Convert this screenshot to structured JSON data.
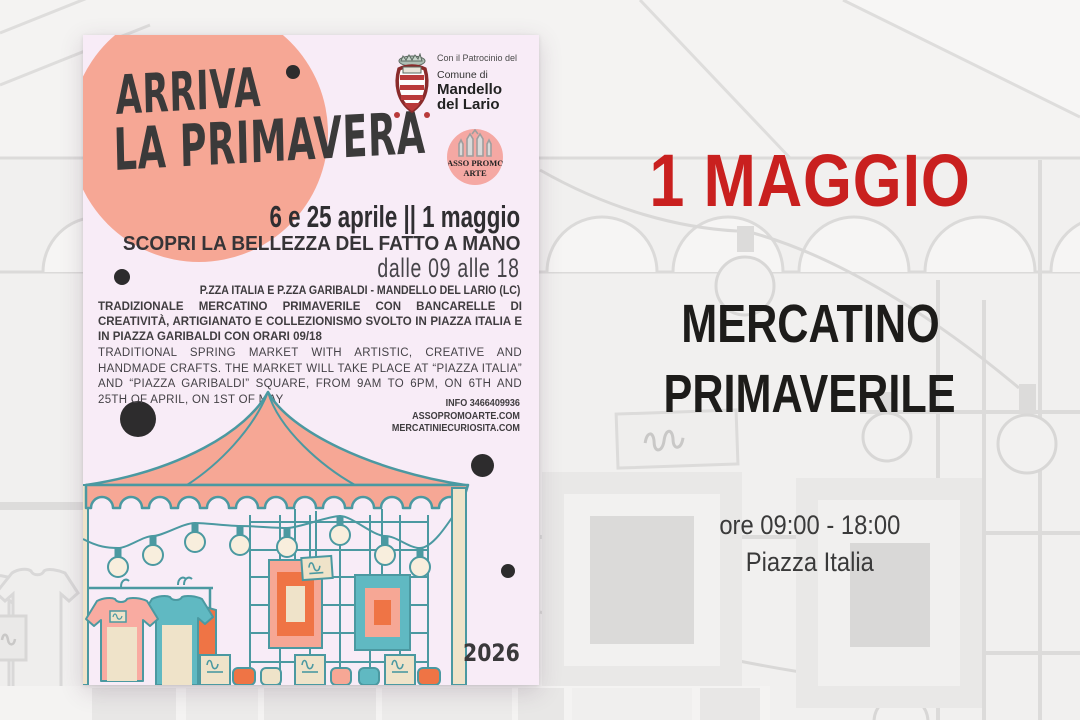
{
  "poster": {
    "title_line1": "ARRIVA",
    "title_line2": "LA PRIMAVERA",
    "patronage": {
      "line1": "Con il Patrocinio del",
      "line2": "Comune di",
      "line3": "Mandello",
      "line4": "del Lario"
    },
    "asso_logo": {
      "line1": "ASSO PROMO",
      "line2": "ARTE"
    },
    "dates": "6 e 25 aprile || 1 maggio",
    "tagline": "SCOPRI LA BELLEZZA DEL FATTO A MANO",
    "hours": "dalle 09 alle 18",
    "location": "P.ZZA ITALIA E P.ZZA GARIBALDI - MANDELLO DEL LARIO (LC)",
    "description_it": "TRADIZIONALE MERCATINO PRIMAVERILE CON BANCARELLE DI CREATIVITÀ, ARTIGIANATO E COLLEZIONISMO SVOLTO IN PIAZZA ITALIA E IN PIAZZA GARIBALDI CON ORARI 09/18",
    "description_en": "TRADITIONAL SPRING MARKET WITH ARTISTIC, CREATIVE AND HANDMADE CRAFTS. THE MARKET WILL TAKE PLACE AT “PIAZZA ITALIA” AND “PIAZZA GARIBALDI” SQUARE, FROM 9AM TO 6PM, ON 6TH AND 25TH OF APRIL, ON 1ST OF MAY",
    "contact": {
      "info": "INFO 3466409936",
      "site1": "ASSOPROMOARTE.COM",
      "site2": "MERCATINIECURIOSITA.COM"
    },
    "year": "2026"
  },
  "event_panel": {
    "date": "1 MAGGIO",
    "title_line1": "MERCATINO",
    "title_line2": "PRIMAVERILE",
    "hours": "ore 09:00 - 18:00",
    "location": "Piazza Italia"
  },
  "colors": {
    "accent_red": "#c9201f",
    "salmon": "#f6a795",
    "teal": "#4b99a1",
    "orange": "#ef7445",
    "cream": "#efe3c9",
    "poster_lavender": "#f8ecf7",
    "ink": "#3a3a3c"
  }
}
